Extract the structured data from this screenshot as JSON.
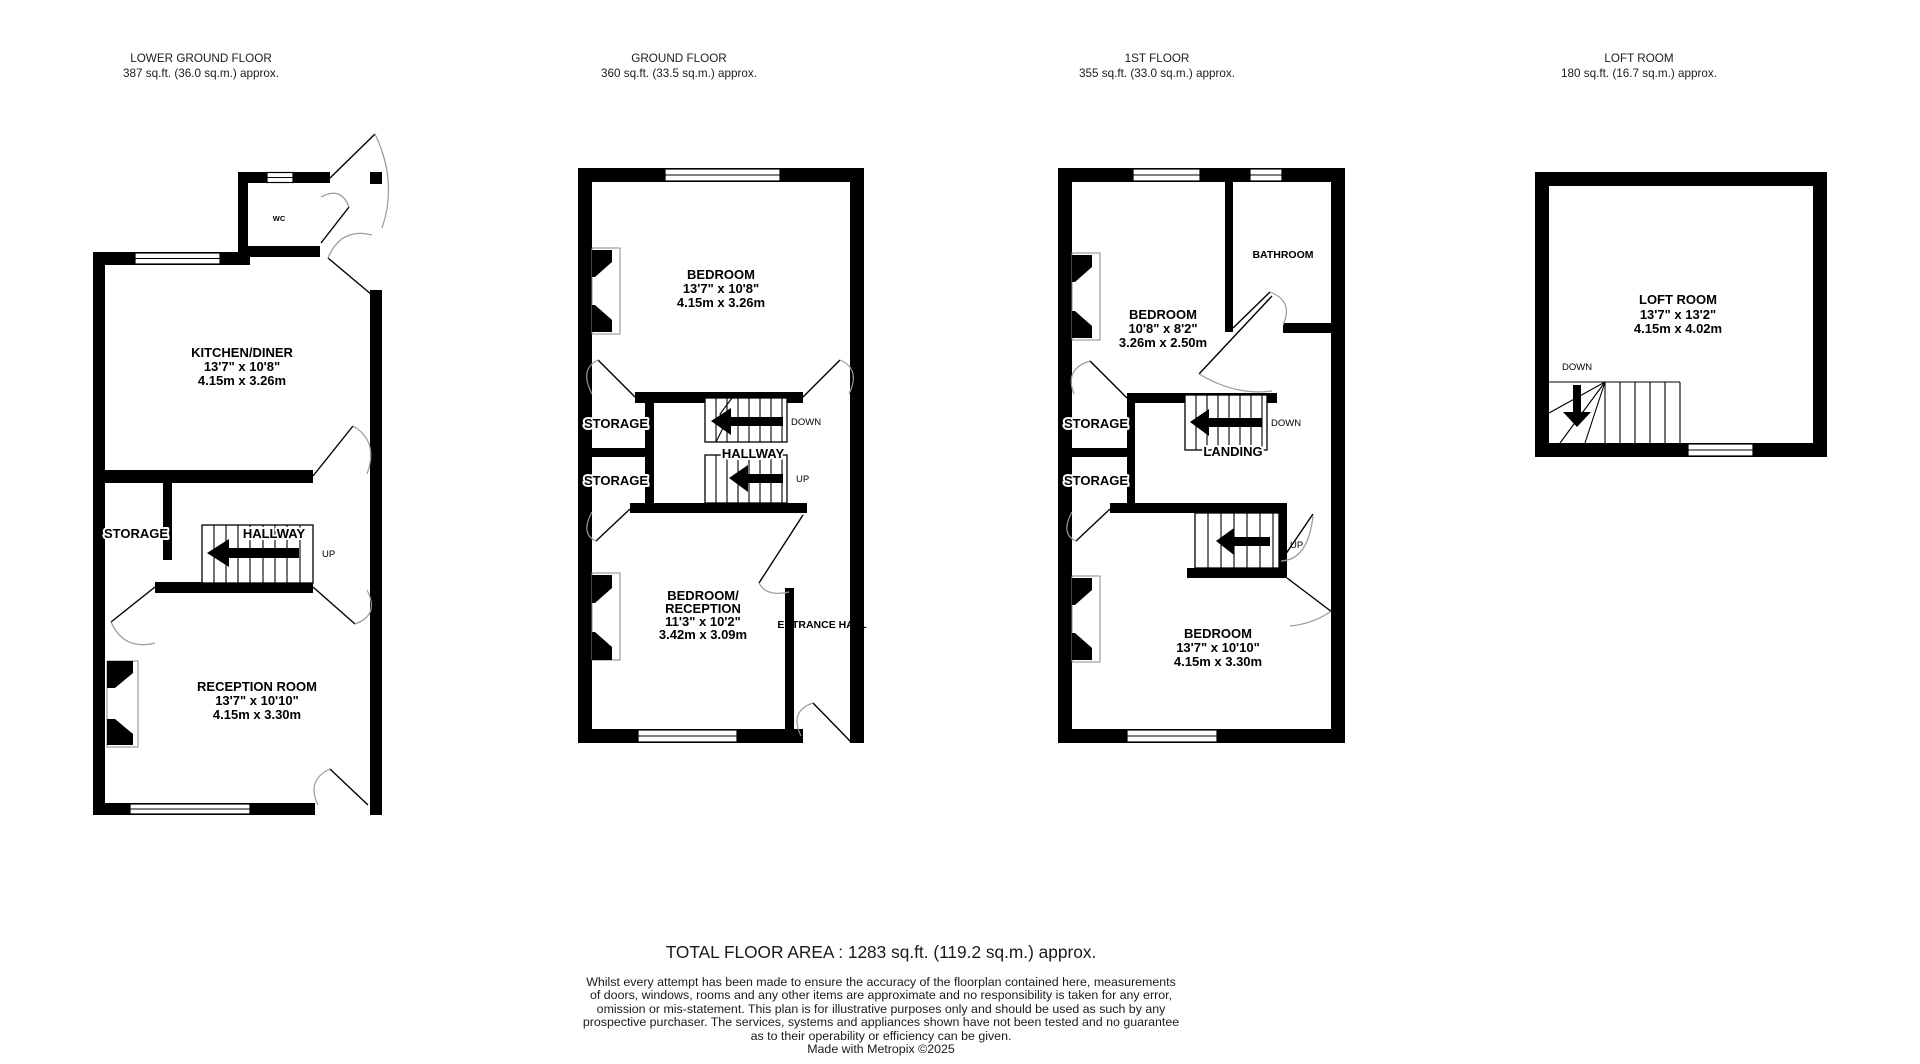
{
  "meta": {
    "wall_color": "#000000",
    "door_arc_color": "#9a9a9a",
    "text_color": "#000000",
    "background": "#ffffff"
  },
  "floors": [
    {
      "name": "LOWER GROUND FLOOR",
      "area": "387 sq.ft. (36.0 sq.m.) approx.",
      "labels": {
        "wc": "WC",
        "kitchen_title": "KITCHEN/DINER",
        "kitchen_dim_i": "13'7\" x 10'8\"",
        "kitchen_dim_m": "4.15m x 3.26m",
        "storage": "STORAGE",
        "hallway": "HALLWAY",
        "up": "UP",
        "reception_title": "RECEPTION ROOM",
        "reception_dim_i": "13'7\" x 10'10\"",
        "reception_dim_m": "4.15m x 3.30m"
      }
    },
    {
      "name": "GROUND FLOOR",
      "area": "360 sq.ft. (33.5 sq.m.) approx.",
      "labels": {
        "bedroom_title": "BEDROOM",
        "bedroom_dim_i": "13'7\" x 10'8\"",
        "bedroom_dim_m": "4.15m x 3.26m",
        "storage_a": "STORAGE",
        "storage_b": "STORAGE",
        "down": "DOWN",
        "hallway": "HALLWAY",
        "up": "UP",
        "bedroom2_line1": "BEDROOM/",
        "bedroom2_line2": "RECEPTION",
        "bedroom2_dim_i": "11'3\" x 10'2\"",
        "bedroom2_dim_m": "3.42m x 3.09m",
        "entrance_hall": "ENTRANCE HALL"
      }
    },
    {
      "name": "1ST FLOOR",
      "area": "355 sq.ft. (33.0 sq.m.) approx.",
      "labels": {
        "bathroom": "BATHROOM",
        "bedroom1_title": "BEDROOM",
        "bedroom1_dim_i": "10'8\" x 8'2\"",
        "bedroom1_dim_m": "3.26m x 2.50m",
        "storage_a": "STORAGE",
        "storage_b": "STORAGE",
        "down": "DOWN",
        "landing": "LANDING",
        "up": "UP",
        "bedroom2_title": "BEDROOM",
        "bedroom2_dim_i": "13'7\" x 10'10\"",
        "bedroom2_dim_m": "4.15m x 3.30m"
      }
    },
    {
      "name": "LOFT ROOM",
      "area": "180 sq.ft. (16.7 sq.m.) approx.",
      "labels": {
        "title": "LOFT ROOM",
        "dim_i": "13'7\" x 13'2\"",
        "dim_m": "4.15m x 4.02m",
        "down": "DOWN"
      }
    }
  ],
  "footer": {
    "total": "TOTAL FLOOR AREA : 1283 sq.ft. (119.2 sq.m.) approx.",
    "disclaimer": [
      "Whilst every attempt has been made to ensure the accuracy of the floorplan contained here, measurements",
      "of doors, windows, rooms and any other items are approximate and no responsibility is taken for any error,",
      "omission or mis-statement. This plan is for illustrative purposes only and should be used as such by any",
      "prospective purchaser. The services, systems and appliances shown have not been tested and no guarantee",
      "as to their operability or efficiency can be given."
    ],
    "credit": "Made with Metropix ©2025"
  }
}
